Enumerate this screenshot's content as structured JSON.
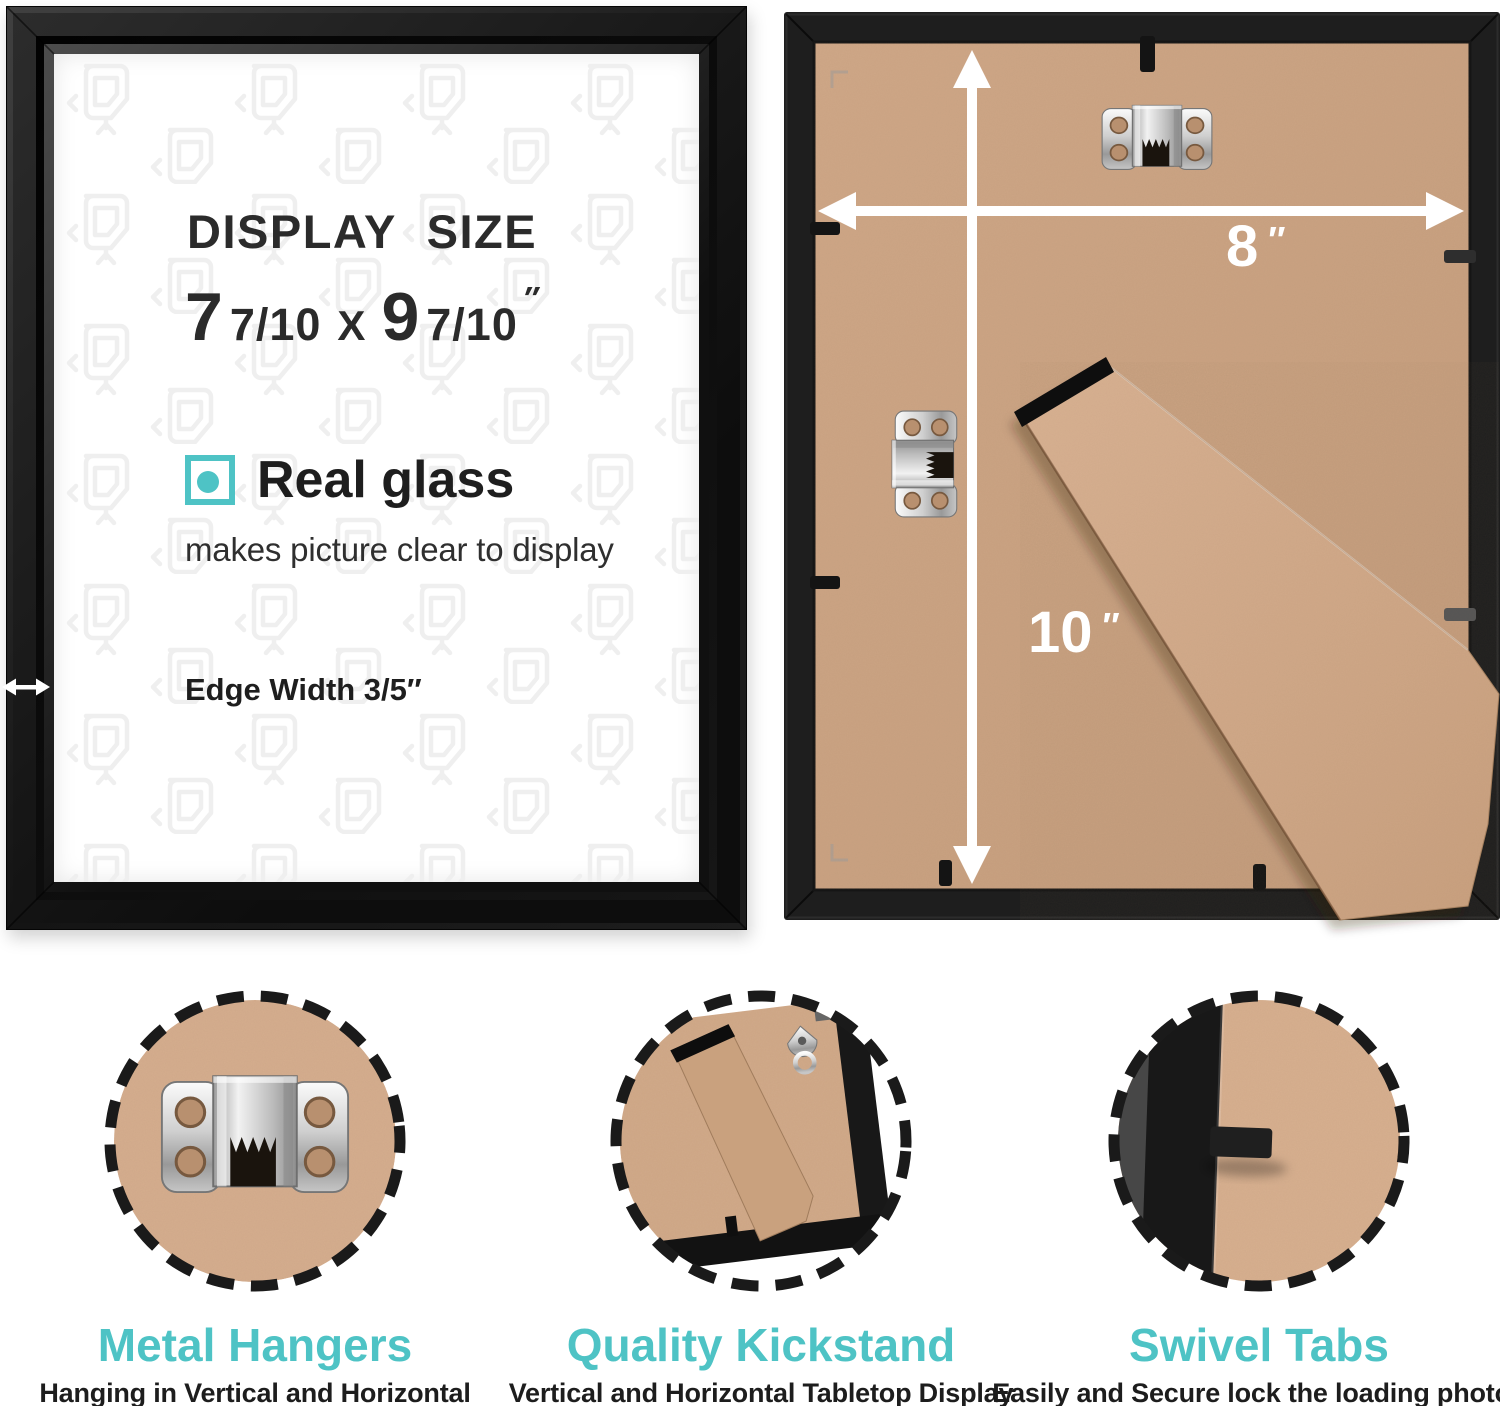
{
  "front_panel": {
    "display_size_label": "DISPLAY SIZE",
    "dimensions": {
      "width_whole": "7",
      "width_fraction": "7/10",
      "separator": "X",
      "height_whole": "9",
      "height_fraction": "7/10",
      "unit": "″"
    },
    "glass_feature": {
      "title": "Real glass",
      "description": "makes picture clear to display"
    },
    "edge_width_label": "Edge Width 3/5″"
  },
  "back_panel": {
    "width_value": "8",
    "width_unit": "″",
    "height_value": "10",
    "height_unit": "″"
  },
  "features": [
    {
      "title": "Metal Hangers",
      "description": "Hanging in Vertical and Horizontal"
    },
    {
      "title": "Quality Kickstand",
      "description": "Vertical and Horizontal Tabletop Display"
    },
    {
      "title": "Swivel Tabs",
      "description": "Easily and Secure lock the loading photos"
    }
  ],
  "icons": {
    "glass_bullet": "teal-square-dot-icon",
    "edge_width_arrow": "double-headed-arrow-icon",
    "width_arrow": "double-headed-arrow-icon",
    "height_arrow": "double-headed-arrow-icon",
    "hanger": "sawtooth-hanger-icon",
    "kickstand": "kickstand-leg",
    "swivel_tab": "swivel-tab",
    "detail_ring": "dashed-circle-ring"
  },
  "colors": {
    "accent": "#4EC3C5",
    "kraft": "#CDA487",
    "frame-black": "#1C1C1C",
    "text-dark": "#2B2B2B",
    "arrow-white": "#FFFFFF"
  }
}
